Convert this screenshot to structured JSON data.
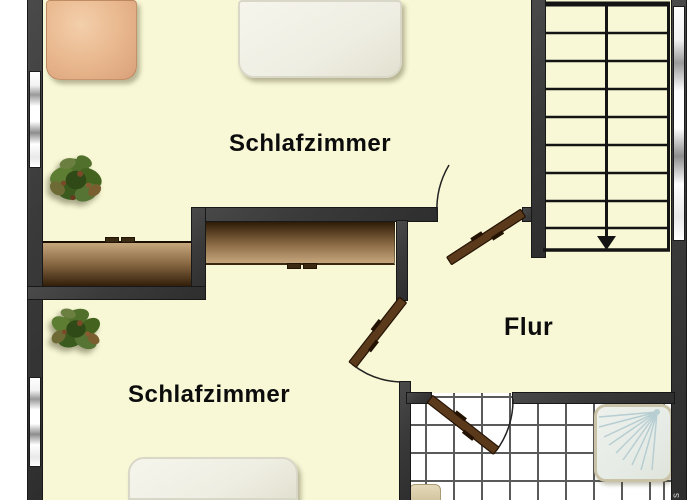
{
  "plan": {
    "rooms": [
      {
        "label": "Schlafzimmer"
      },
      {
        "label": "Schlafzimmer"
      },
      {
        "label": "Flur"
      }
    ],
    "watermark": "s"
  },
  "icons": {
    "plant": "potted-plant top view",
    "stairs_direction": "down-arrow",
    "shower_spray": "radial spray lines",
    "door": "hinged door leaf with quarter-circle swing arc"
  },
  "colors": {
    "floor": "#f8f8d6",
    "wall": "#3a3a3a",
    "tile_line": "#5a5a5a",
    "door": "#5b3a1c",
    "wd_dark": "#2a1804",
    "wd_light": "#c6a67d",
    "bed_orange": "#e8b68c",
    "bed_white": "#efeee3",
    "plant_green": "#4c6b2a",
    "spray": "#b7ced2",
    "line": "#141414"
  }
}
